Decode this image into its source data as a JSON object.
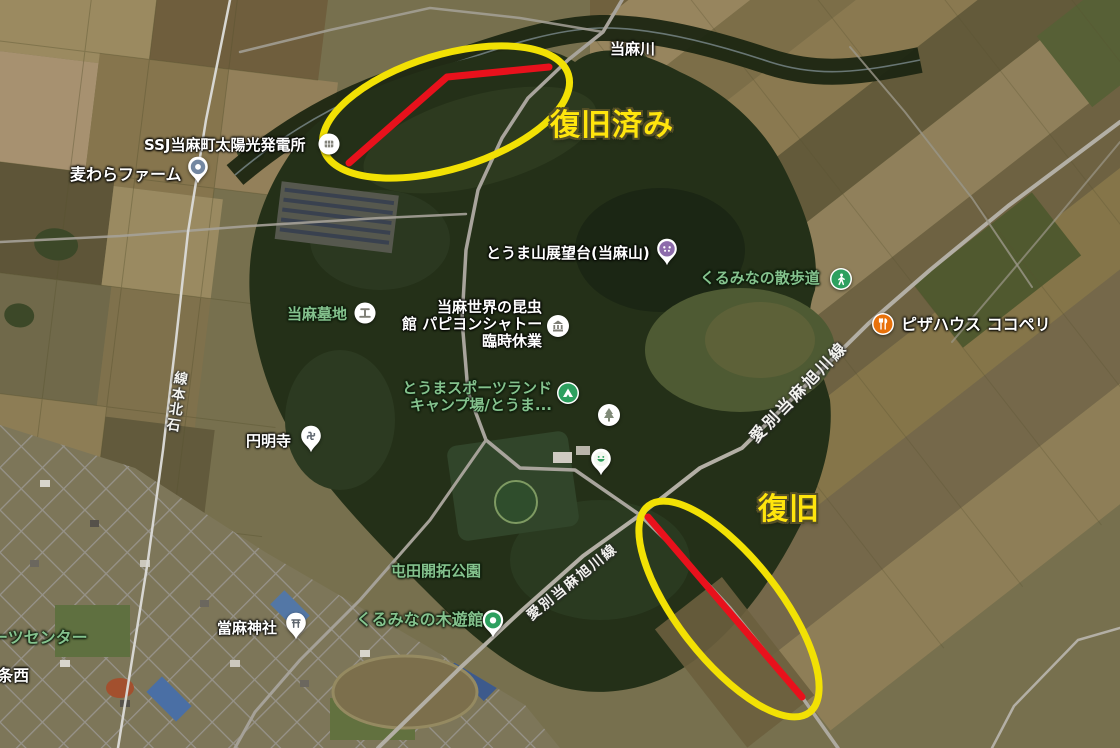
{
  "annotations": {
    "restored": "復旧済み",
    "restoration": "復旧"
  },
  "labels": {
    "river": "当麻川",
    "railway_line": "石北本線",
    "road_name": "愛別当麻旭川線",
    "solar_plant": "SSJ当麻町太陽光発電所",
    "farm": "麦わらファーム",
    "observatory": "とうま山展望台(当麻山)",
    "walking_trail": "くるみなの散歩道",
    "cemetery": "当麻墓地",
    "insect_museum": {
      "line1": "当麻世界の昆虫",
      "line2": "館 パピヨンシャトー",
      "line3": "臨時休業"
    },
    "pizza_house": "ピザハウス ココペリ",
    "sports_land": {
      "line1": "とうまスポーツランド",
      "line2": "キャンプ場/とうま..."
    },
    "temple": "円明寺",
    "pioneer_park": "屯田開拓公園",
    "shrine": "當麻神社",
    "wood_play_museum": "くるみなの木遊館",
    "sports_center_partial": "ーツセンター",
    "block_partial": "4条西"
  },
  "icons": {
    "walking_trail": "hiker-in-green-circle",
    "pizza_house": "fork-knife-in-orange-circle",
    "campground": "tent-in-green-circle",
    "park": "tree-in-white-circle",
    "cemetery": "grave-in-white-circle",
    "museum": "columned-building-in-white-circle",
    "solar_plant": "panel-in-white-circle",
    "farm": "blue-dot-pin",
    "observatory": "purple-dots-pin",
    "playground": "green-smiley-pin",
    "temple": "manji-pin",
    "shrine": "torii-pin",
    "wood_play_museum": "green-ring-pin"
  },
  "colors": {
    "annotation_yellow": "#f2e104",
    "annotation_red": "#e8111c",
    "poi_green": "#2da05f",
    "poi_orange": "#e8710a",
    "poi_purple": "#8d6cab"
  }
}
